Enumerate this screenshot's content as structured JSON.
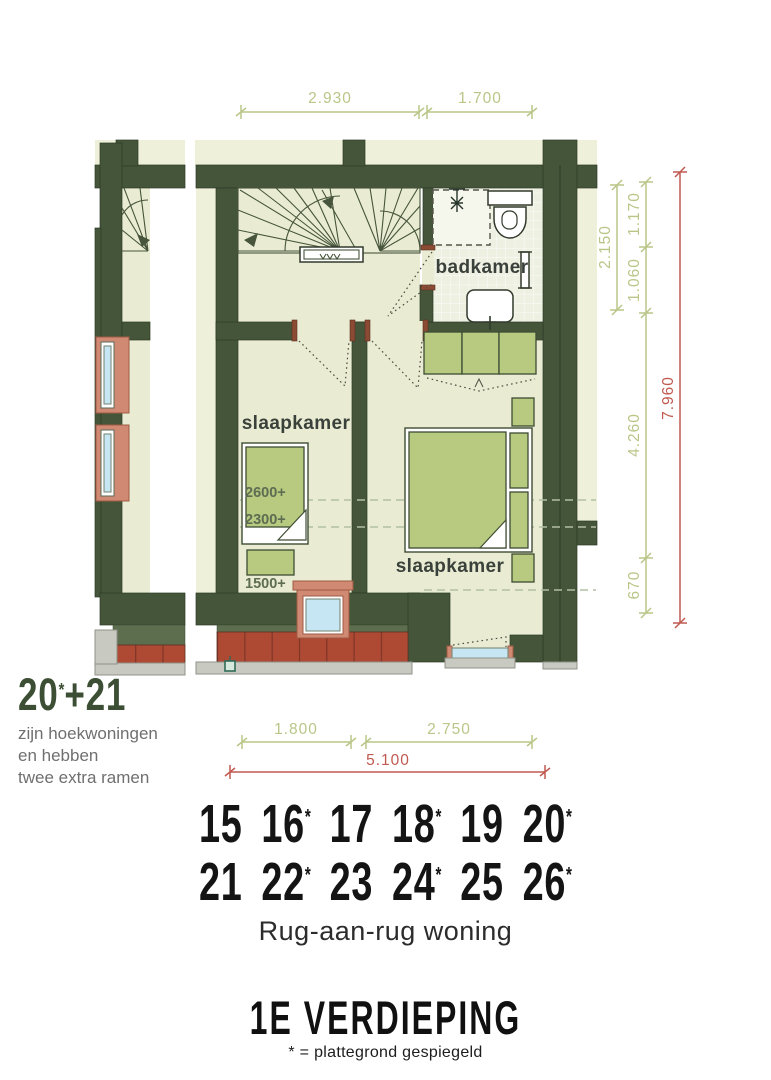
{
  "plan": {
    "room_labels": {
      "bathroom": "badkamer",
      "bedroom_left": "slaapkamer",
      "bedroom_right": "slaapkamer"
    },
    "height_labels": {
      "h1": "2600+",
      "h2": "2300+",
      "h3": "1500+"
    },
    "dims": {
      "top_left": "2.930",
      "top_right": "1.700",
      "right_a": "2.150",
      "right_b": "1.170",
      "right_c": "1.060",
      "right_d": "4.260",
      "right_e": "670",
      "right_total": "7.960",
      "bottom_a": "1.800",
      "bottom_b": "2.750",
      "bottom_total": "5.100"
    }
  },
  "corner_note": {
    "big": {
      "left": "20",
      "star": "*",
      "right": "+21"
    },
    "lines": [
      "zijn hoekwoningen",
      "en hebben",
      "twee extra ramen"
    ]
  },
  "footer": {
    "rows": [
      [
        "15",
        "16*",
        "17",
        "18*",
        "19",
        "20*"
      ],
      [
        "21",
        "22*",
        "23",
        "24*",
        "25",
        "26*"
      ]
    ],
    "type_label": "Rug-aan-rug woning",
    "title": "1E VERDIEPING",
    "footnote": "* = plattegrond gespiegeld"
  },
  "colors": {
    "wall": "#44553a",
    "floor": "#e9ecd3",
    "cream": "#eef0da",
    "tilefloor": "#eef0e2",
    "furn": "#b7ca80",
    "brick": "#ae4a34",
    "salmon": "#d08a73",
    "glass": "#c5e6f2",
    "olive": "#5c6e4e",
    "gray": "#c8c9c1",
    "dimg": "#b9c687",
    "dimr": "#c05a50",
    "dash": "#b3bfa3",
    "hlabel": "#5e6d51",
    "note": "#3c4f34",
    "ink": "#141414",
    "notegray": "#6f6f6f"
  }
}
